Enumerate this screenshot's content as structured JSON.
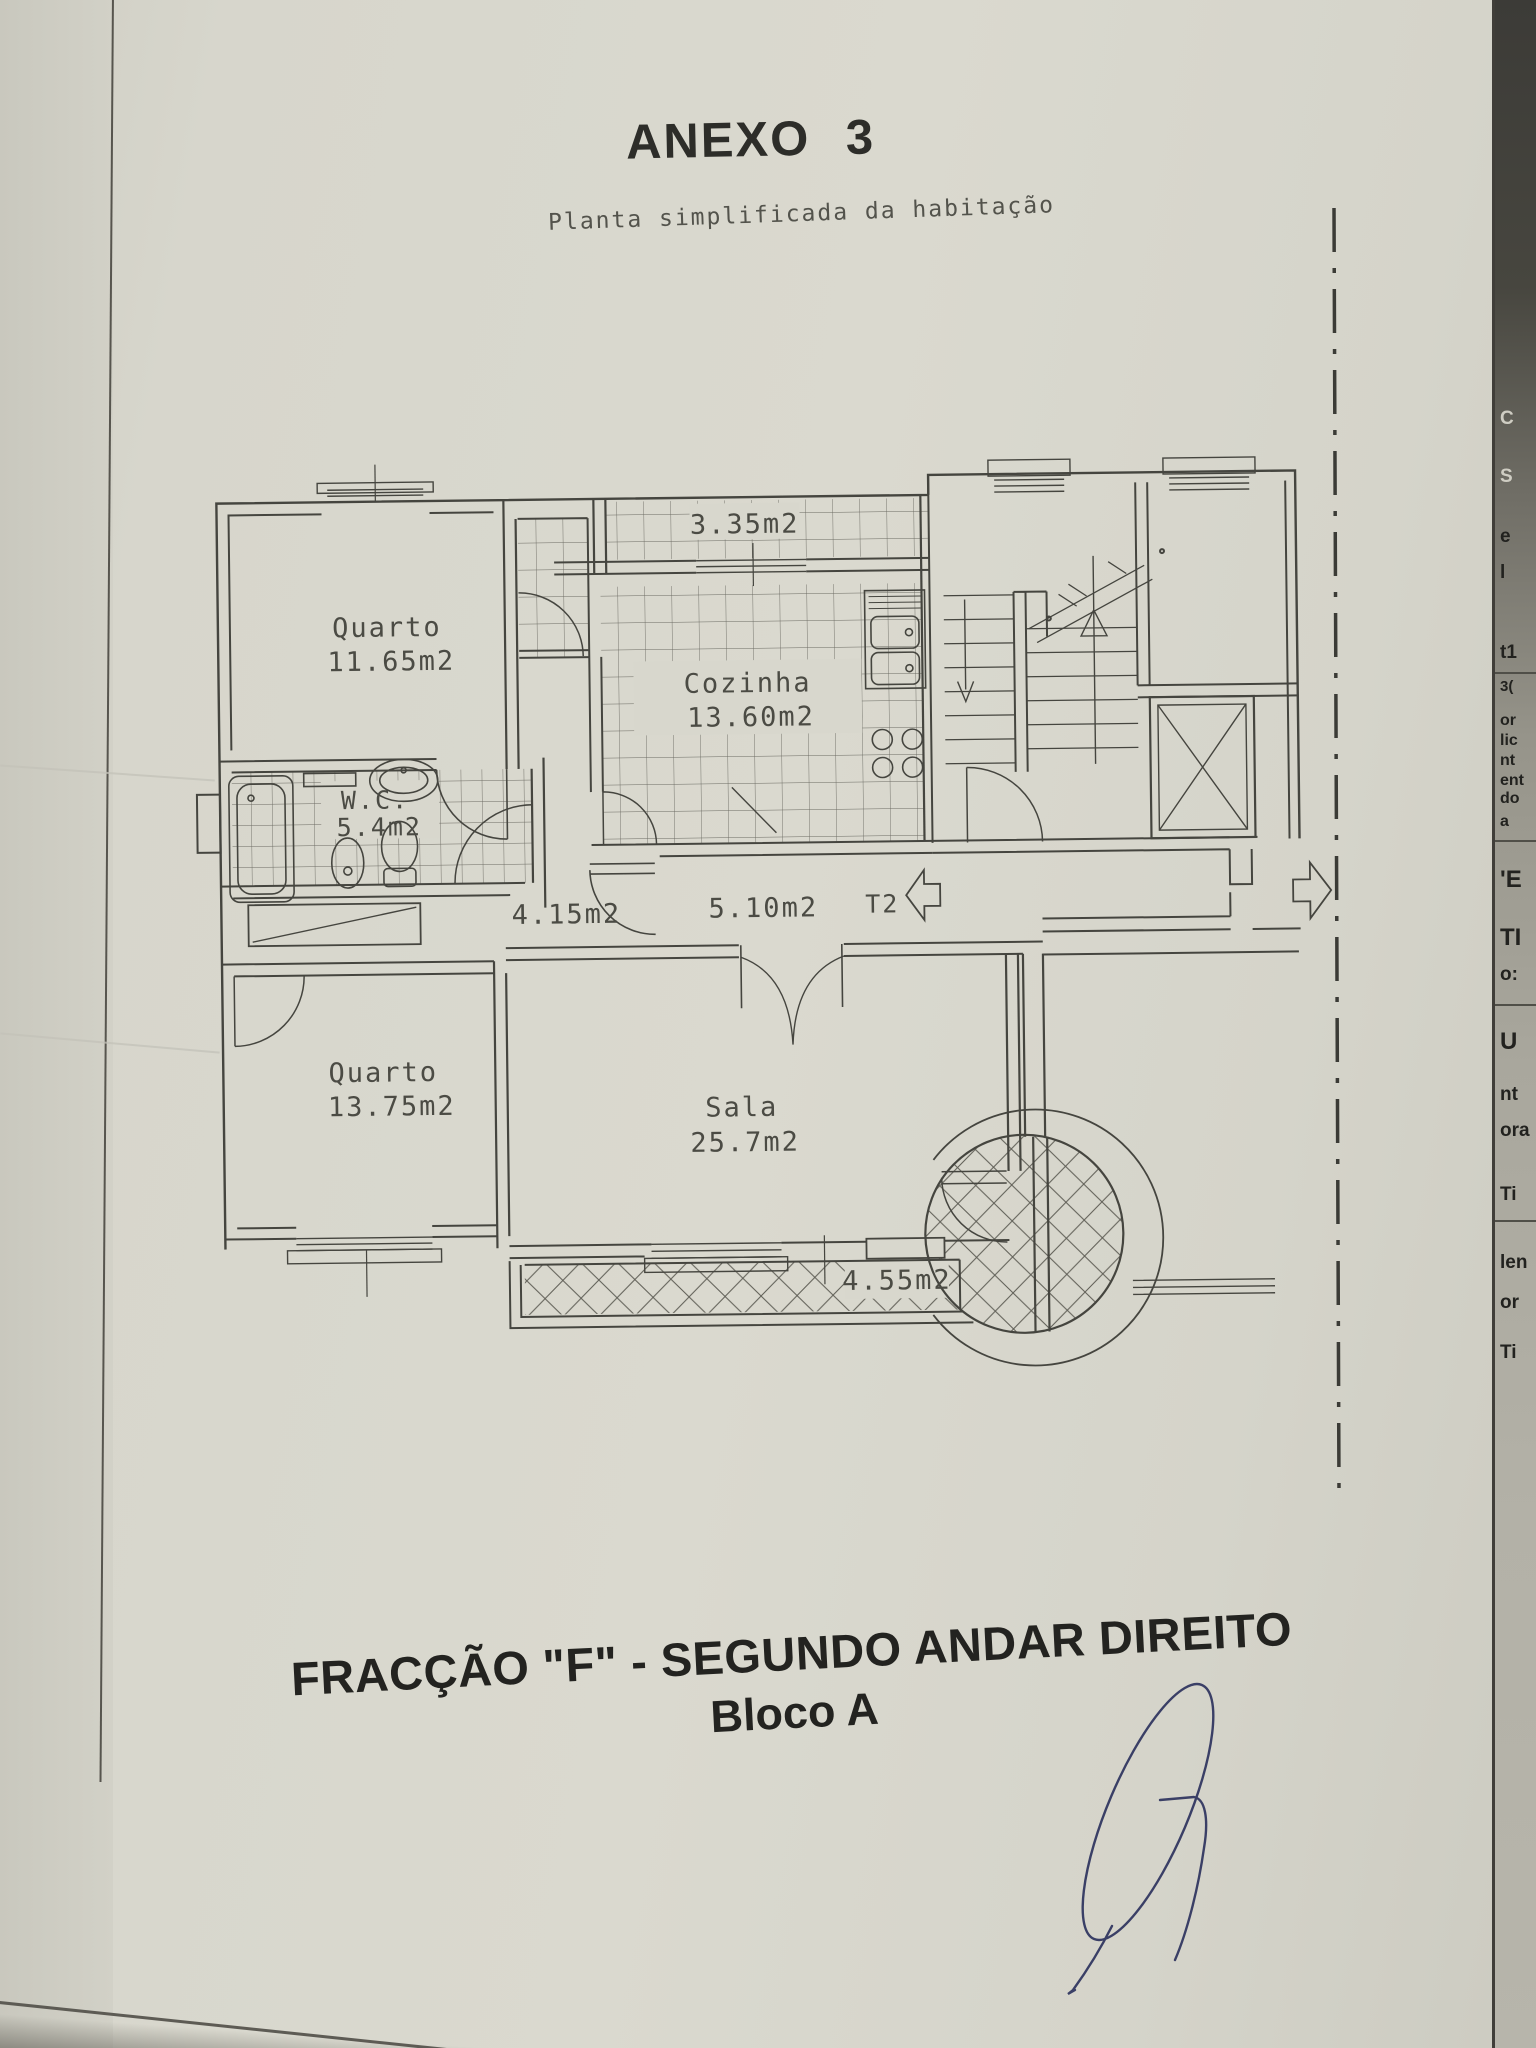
{
  "page": {
    "title": "ANEXO 3",
    "subtitle": "Planta simplificada da habitação",
    "caption": "FRACÇÃO \"F\" - SEGUNDO ANDAR DIREITO",
    "caption_block": "Bloco A"
  },
  "plan": {
    "unit_type": "T2",
    "rooms": {
      "quarto1": {
        "name": "Quarto",
        "area": "11.65m2"
      },
      "cozinha": {
        "name": "Cozinha",
        "area": "13.60m2"
      },
      "wc": {
        "name": "W.C.",
        "area": "5.4m2"
      },
      "quarto2": {
        "name": "Quarto",
        "area": "13.75m2"
      },
      "sala": {
        "name": "Sala",
        "area": "25.7m2"
      }
    },
    "areas": {
      "marquise": "3.35m2",
      "hall": "4.15m2",
      "corredor": "5.10m2",
      "varanda": "4.55m2"
    }
  },
  "underlying_page_fragments": [
    "C",
    "S",
    "e",
    "l",
    "t1",
    "3(",
    "or",
    "lic",
    "nt",
    "ent",
    "do",
    "a",
    "'E",
    "TI",
    "o:",
    "U",
    "nt",
    "ora",
    "Ti",
    "len",
    "or",
    "Ti"
  ],
  "colors": {
    "paper": "#d8d7cd",
    "plan_line": "#45453f",
    "signature_ink": "#3a3f66"
  }
}
